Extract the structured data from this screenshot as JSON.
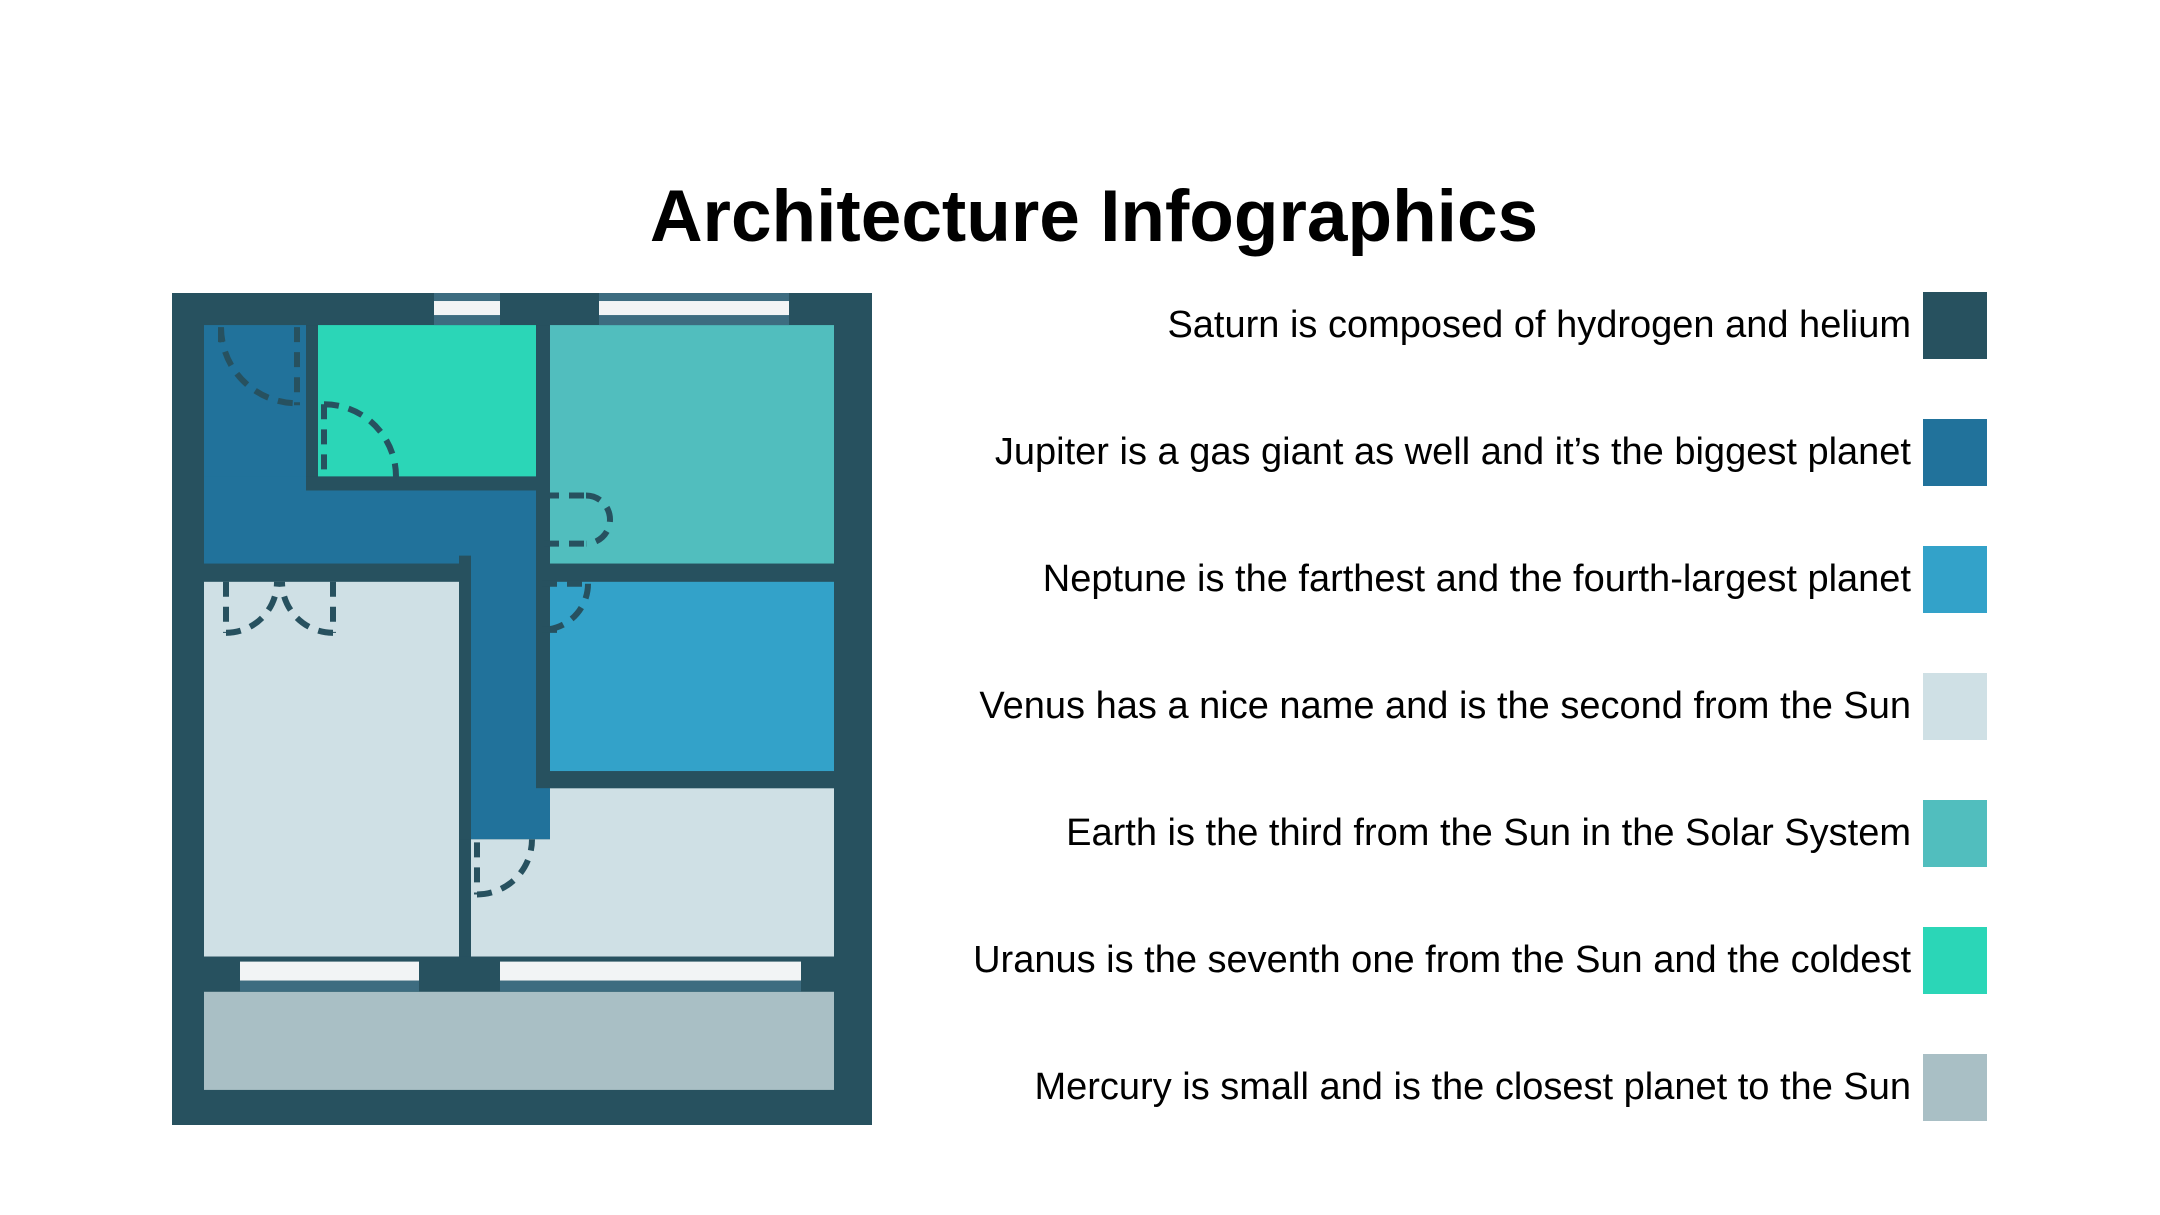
{
  "title": "Architecture Infographics",
  "legend": {
    "items": [
      {
        "name": "saturn",
        "label": "Saturn is composed of hydrogen and helium",
        "color": "#27515F"
      },
      {
        "name": "jupiter",
        "label": "Jupiter is a gas giant as well and it’s the biggest planet",
        "color": "#21729B"
      },
      {
        "name": "neptune",
        "label": "Neptune is the farthest and the fourth-largest planet",
        "color": "#33A2C9"
      },
      {
        "name": "venus",
        "label": "Venus has a nice name and is the second from the Sun",
        "color": "#CFE0E5"
      },
      {
        "name": "earth",
        "label": "Earth is the third from the Sun in the Solar System",
        "color": "#51BEBE"
      },
      {
        "name": "uranus",
        "label": "Uranus is the seventh one from the Sun and the coldest",
        "color": "#2BD6B7"
      },
      {
        "name": "mercury",
        "label": "Mercury is small and is the closest planet to the Sun",
        "color": "#A9BFC5"
      }
    ]
  },
  "floor_plan": {
    "description": "Apartment floor plan with rooms colored to match the legend",
    "colors": {
      "wall": "#27515F",
      "hall": "#21729B",
      "small_top_room": "#2BD6B7",
      "top_right_room": "#51BEBE",
      "right_room": "#33A2C9",
      "living_room": "#CFE0E5",
      "balcony": "#A9BFC5",
      "window_frame": "#3D6C80",
      "window_glass": "#F2F4F5"
    }
  },
  "page": {
    "background": "#FFFFFF",
    "text_color": "#000000"
  }
}
